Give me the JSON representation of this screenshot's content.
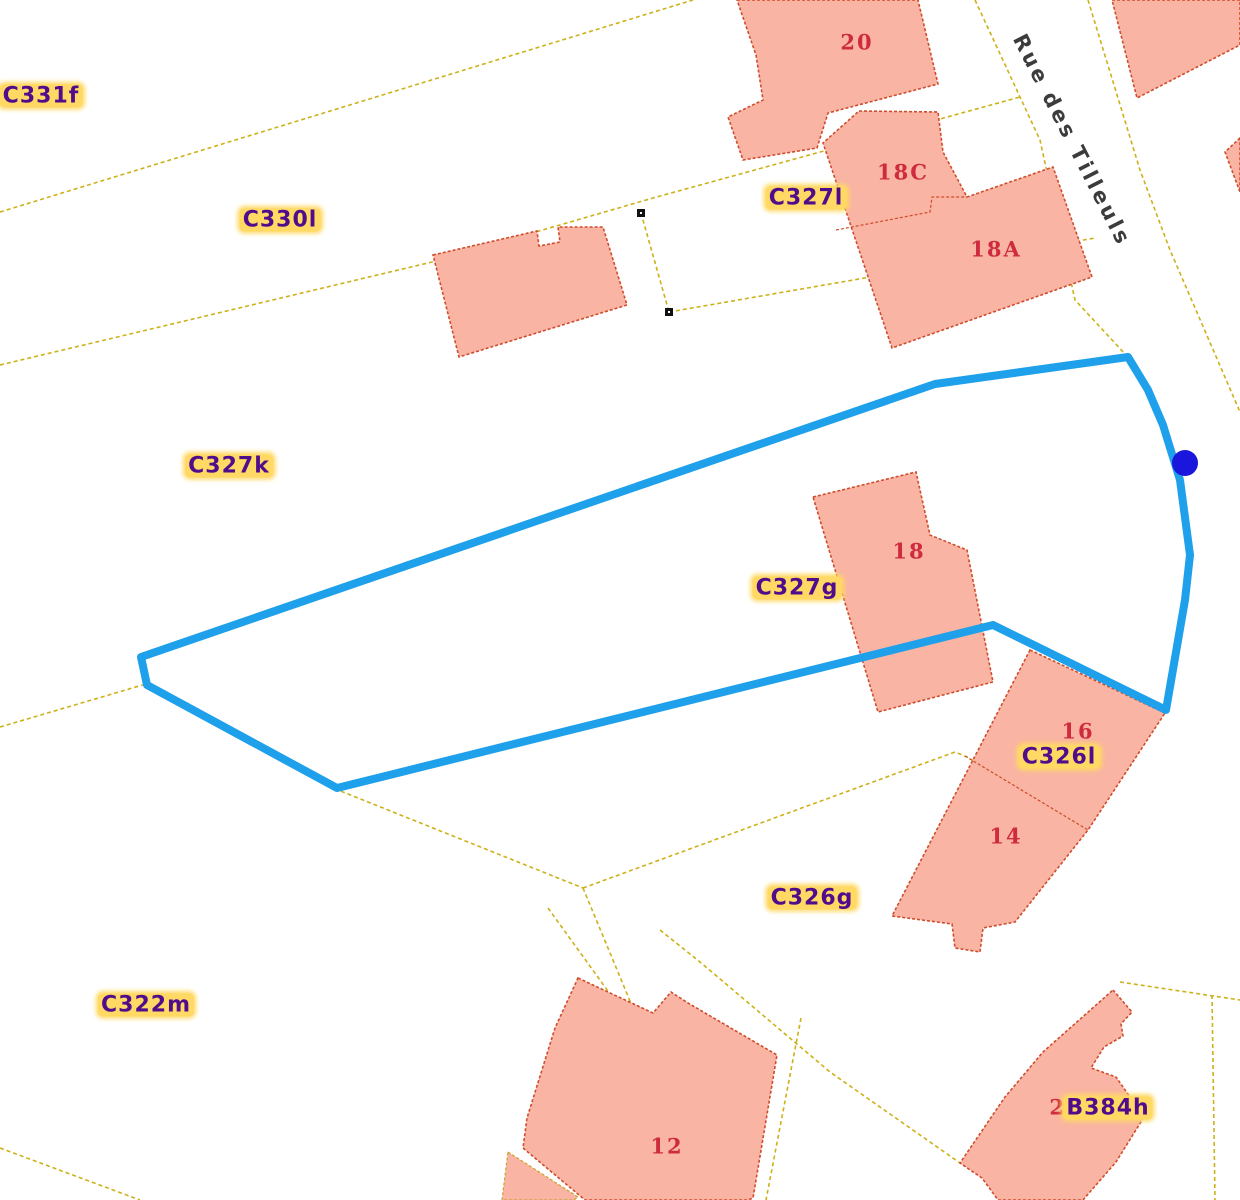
{
  "colors": {
    "background": "#FFFFFF",
    "parcel_line": "#CDB119",
    "building_fill": "#F9B4A3",
    "building_border": "#CF4C2C",
    "selection_outline": "#1EA0EB",
    "selection_point": "#1A16DB",
    "parcel_label_color": "#4F0D8C",
    "parcel_label_halo": "#FFD964",
    "house_number_color": "#CF2B3E",
    "street_label_color": "#3C3C3C",
    "marker_color": "#111111",
    "hatch_color": "#C9A227"
  },
  "street": {
    "name": "Rue des Tilleuls"
  },
  "parcels": [
    {
      "id": "C331f"
    },
    {
      "id": "C330l"
    },
    {
      "id": "C327l"
    },
    {
      "id": "C327k"
    },
    {
      "id": "C327g"
    },
    {
      "id": "C326l"
    },
    {
      "id": "C326g"
    },
    {
      "id": "C322m"
    },
    {
      "id": "B384h"
    }
  ],
  "houses": [
    "20",
    "18C",
    "18A",
    "18",
    "16",
    "14",
    "12",
    "21"
  ]
}
